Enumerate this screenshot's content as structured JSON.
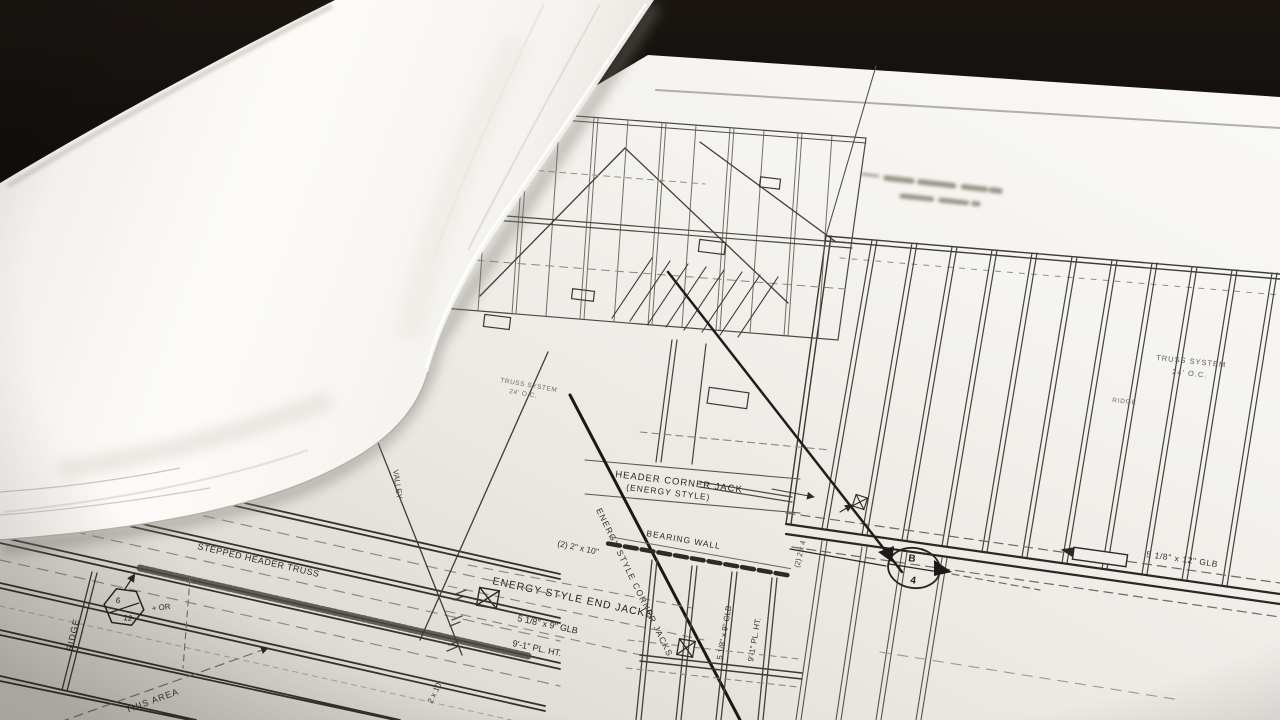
{
  "scene": {
    "subject": "photograph of rolled architectural blueprint over a flat roof-framing plan",
    "background_color": "#0a0807",
    "paper_color": "#f3f2ee",
    "ink_color": "#36332d",
    "ink_dark": "#1f1d19",
    "ink_faint": "#6e6a60"
  },
  "annotations": {
    "header_jack_1": "HEADER CORNER JACK",
    "header_jack_2": "(ENERGY STYLE)",
    "bearing_wall": "BEARING WALL",
    "pair_2x10": "(2) 2\" x 10\"",
    "end_jacks": "ENERGY STYLE END JACKS",
    "glb9_a": "5 1/8\" x 9\" GLB",
    "plht_a": "9'-1\" PL. HT.",
    "corner_jacks_diag": "ENERGY STYLE CORNER JACKS",
    "glb9_b": "5 1/8\" x 9\" GLB",
    "plht_b": "9'-1\" PL. HT.",
    "pair_2x4": "(2) 2 x 4",
    "stepped_header": "STEPPED HEADER TRUSS",
    "ridge_left": "RIDGE",
    "pitch_num": "6",
    "pitch_den": "12",
    "plus_or": "+ OR",
    "this_area": "THIS AREA",
    "joist_2x10": "2 x 10",
    "valley": "VALLEY",
    "truss_sys_1": "TRUSS SYSTEM",
    "truss_sys_2": "24' O.C.",
    "truss_sys_c1": "TRUSS SYSTEM",
    "truss_sys_c2": "24' O.C.",
    "ridge_right": "RIDGE",
    "glb12": "5 1/8\" x 12\" GLB",
    "sec_b": "B",
    "sec_4": "4"
  }
}
